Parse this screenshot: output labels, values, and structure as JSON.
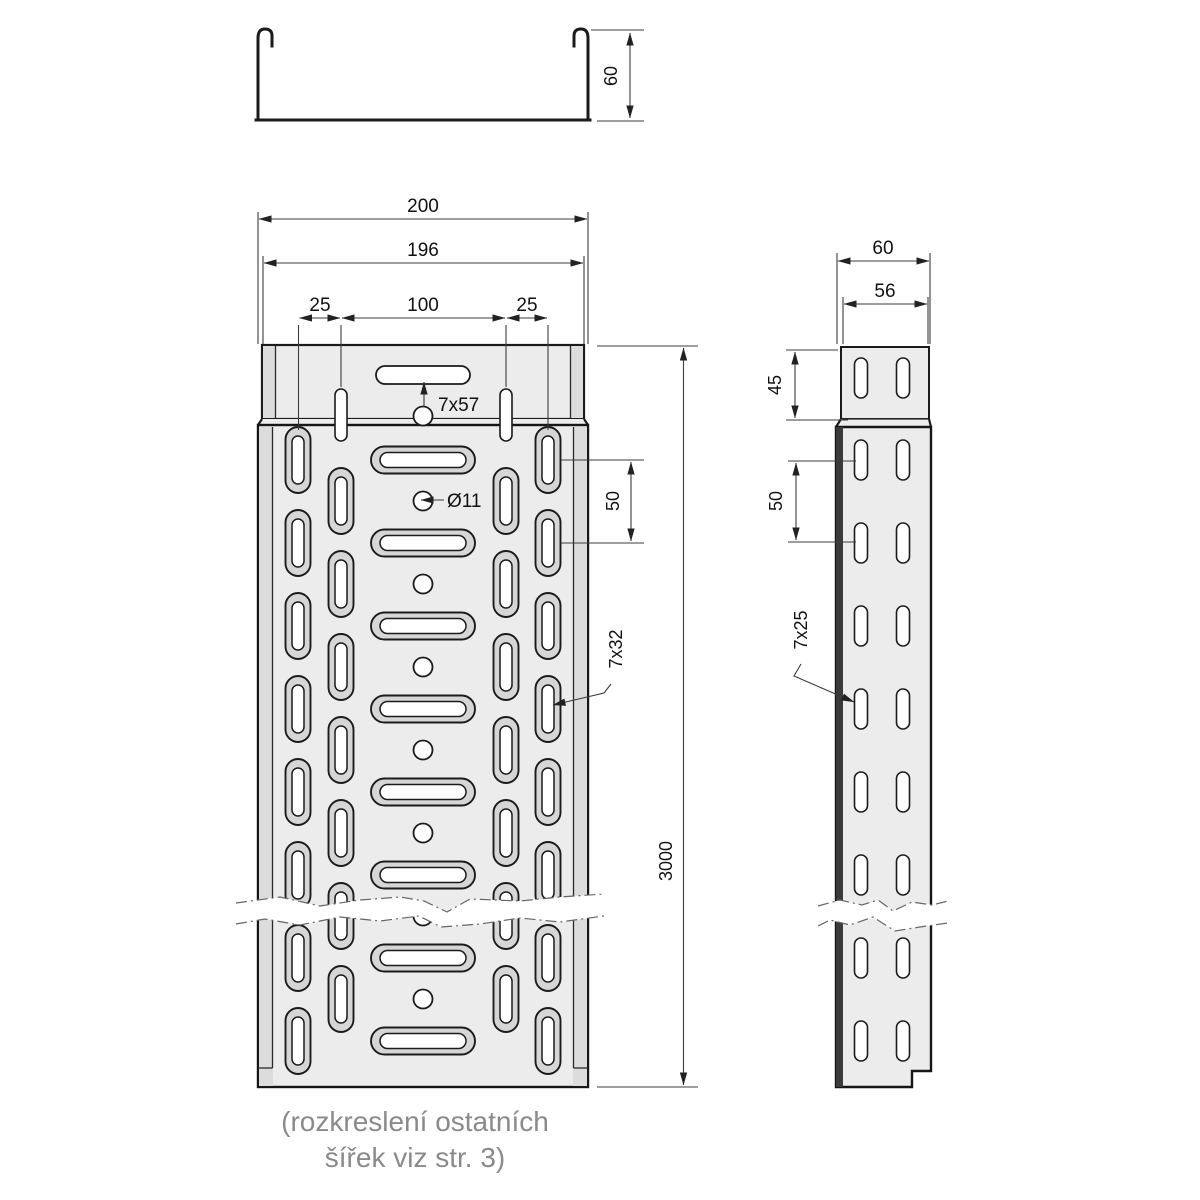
{
  "caption": {
    "line1": "(rozkreslení ostatních",
    "line2": "šířek viz str. 3)"
  },
  "cross_section": {
    "height": "60"
  },
  "plan_view": {
    "overall_width": "200",
    "coupling_width": "196",
    "offset_left": "25",
    "center_span": "100",
    "offset_right": "25",
    "coupling_slot_label": "7x57",
    "hole_label": "Ø11",
    "slot_pitch": "50",
    "side_slot_label": "7x32",
    "length": "3000"
  },
  "side_view": {
    "width": "60",
    "coupling_width": "56",
    "coupling_height": "45",
    "slot_pitch": "50",
    "slot_label": "7x25"
  },
  "colors": {
    "background": "#ffffff",
    "metal_fill": "#ececec",
    "wall_band": "#dcdcdc",
    "slot_rim": "#d6d6d6",
    "outline": "#1b1b1b",
    "dimension_line": "#3c3c3c",
    "caption_text": "#8a8a8a"
  }
}
